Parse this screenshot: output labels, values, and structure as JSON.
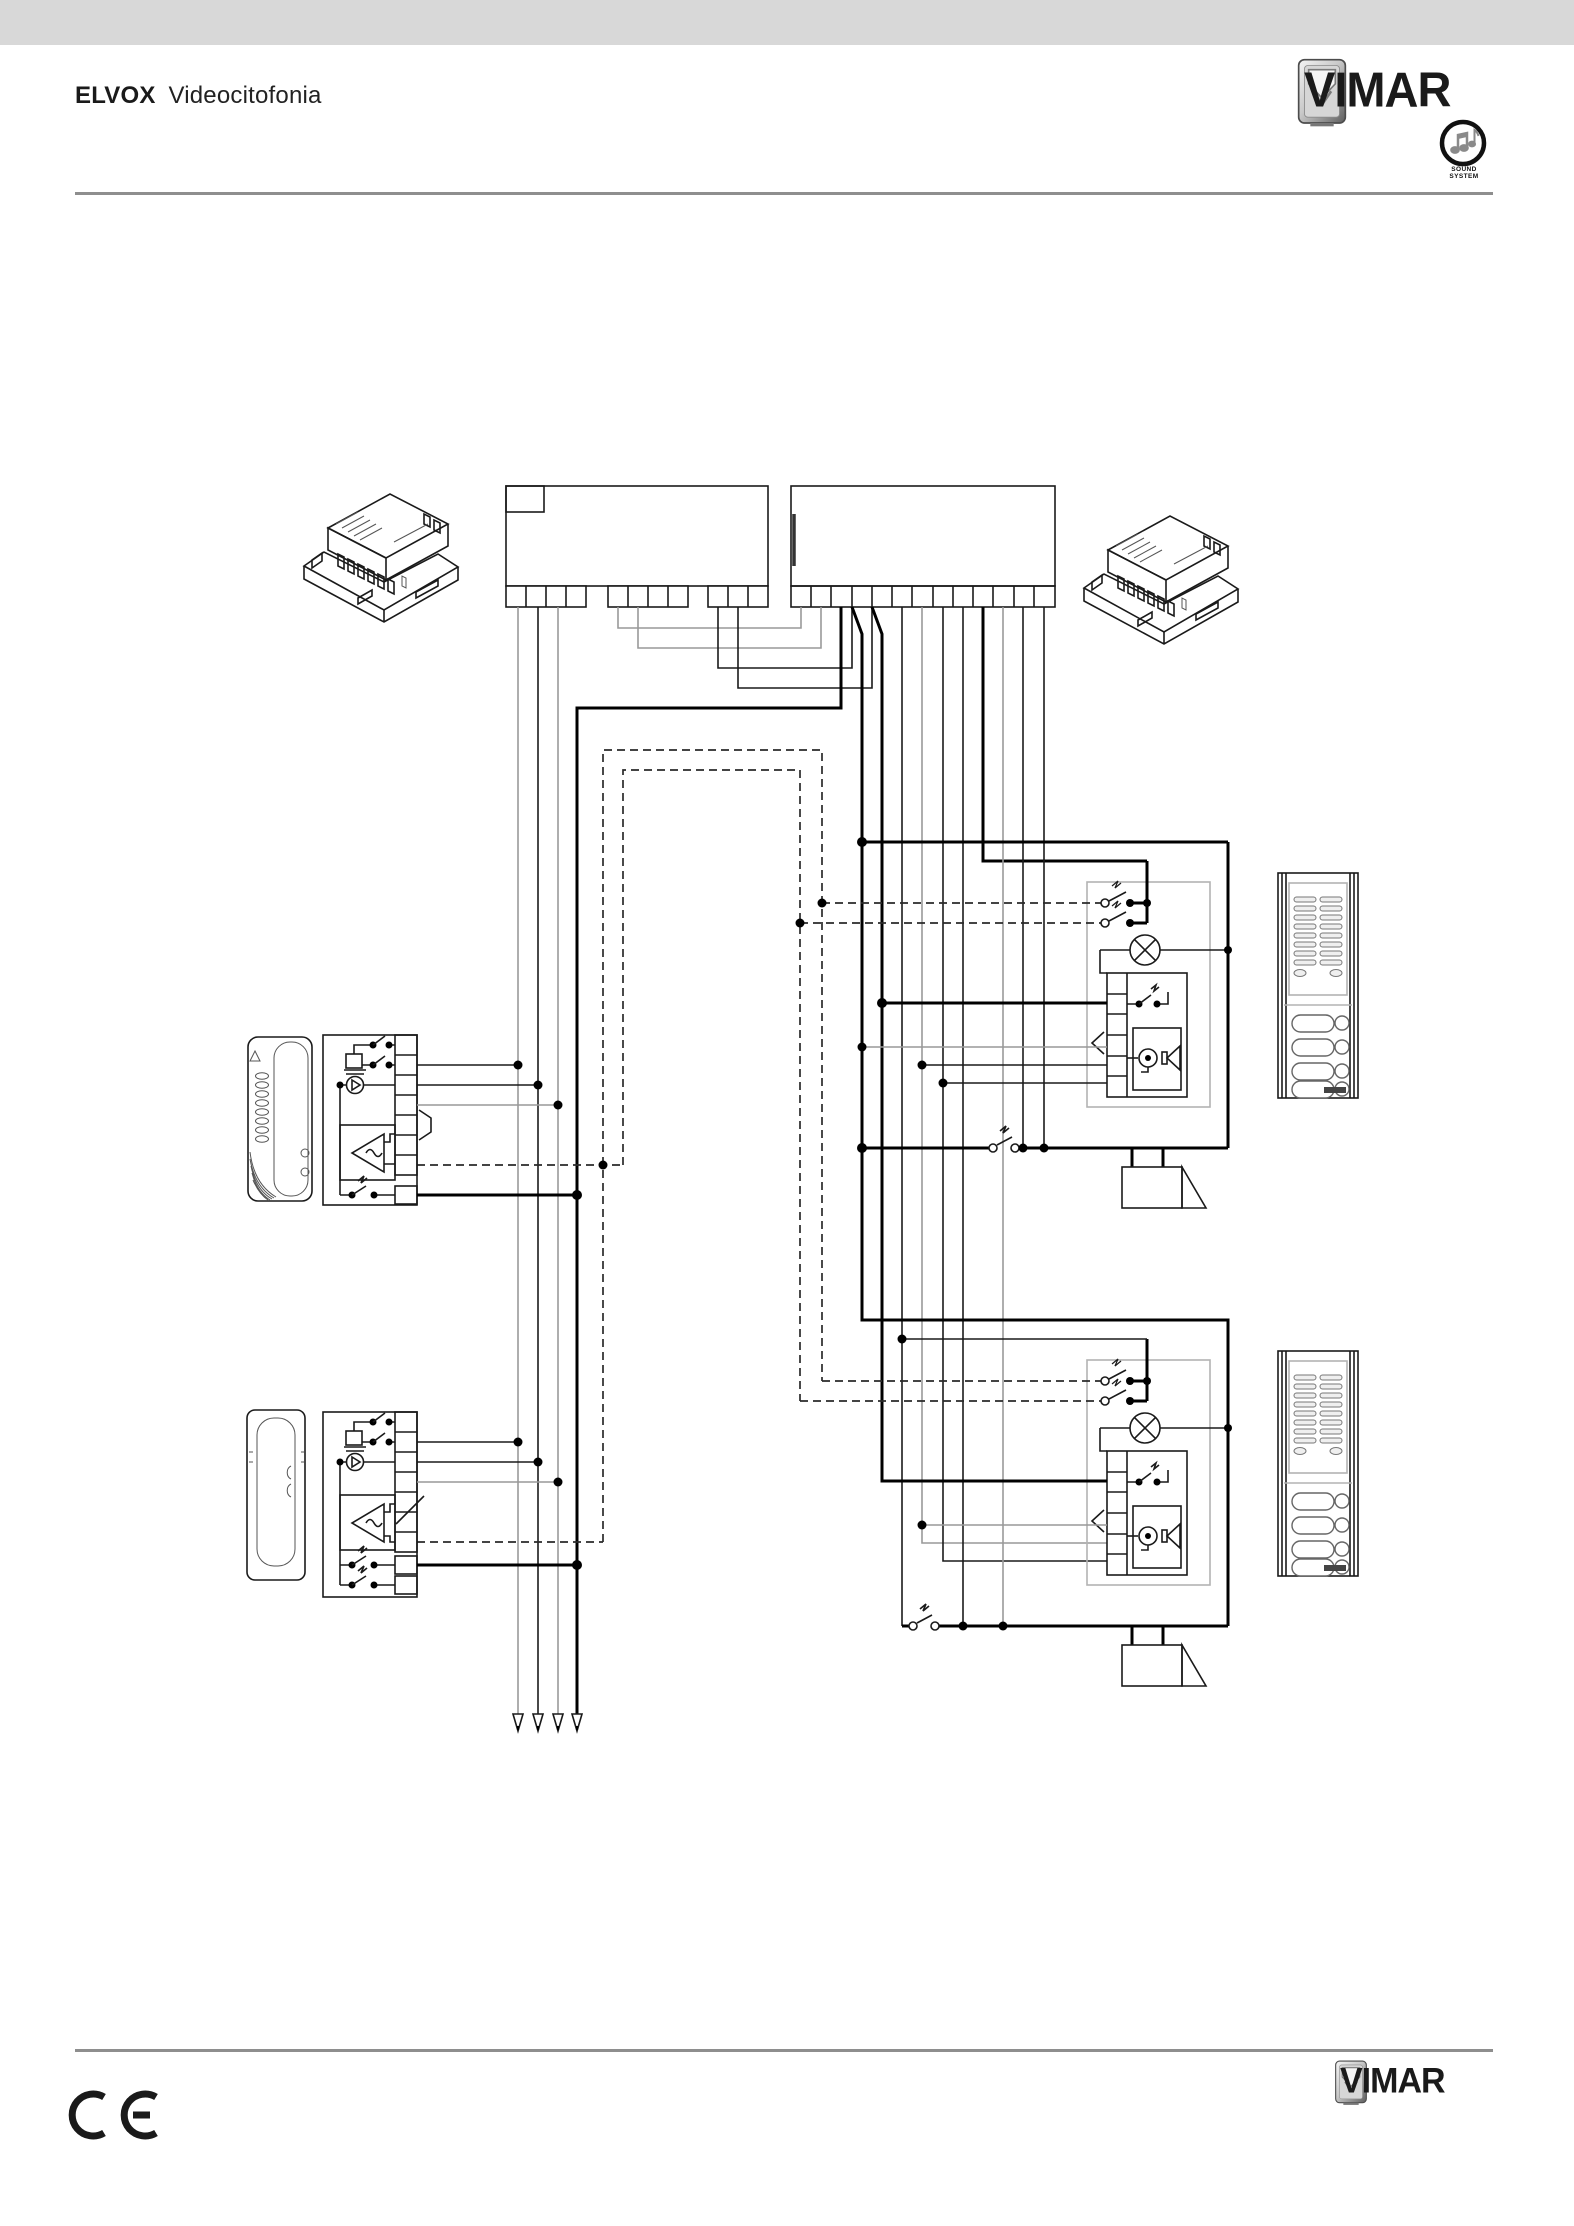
{
  "page": {
    "background": "#ffffff",
    "topbar_color": "#d8d8d8",
    "rule_color": "#8e8e8e"
  },
  "header": {
    "brand": "ELVOX",
    "product": "Videocitofonia",
    "logo_text": "VIMAR",
    "sound_system_label": "SOUND SYSTEM"
  },
  "footer": {
    "ce_mark": "CE",
    "logo_text": "VIMAR"
  },
  "diagram": {
    "type": "wiring-schematic",
    "description": "Audio door-entry system wiring diagram",
    "power_supply_modules": 2,
    "terminal_units": 2,
    "indoor_interphones": 2,
    "outdoor_entrance_panels": 2,
    "entrance_panel_call_buttons": 4,
    "electric_door_locks": 2,
    "riser_continuation_arrows": 4,
    "wire_colors": {
      "primary": "#1a1a1a",
      "secondary": "#999999",
      "thick_bus": "#000000"
    },
    "icons": [
      "din-power-supply-icon",
      "terminal-block-icon",
      "buzzer-icon",
      "receiver-icon",
      "amplifier-icon",
      "switch-icon",
      "lamp-icon",
      "microphone-icon",
      "speaker-icon",
      "door-lock-icon",
      "handset-icon",
      "entrance-panel-icon",
      "arrow-down-icon"
    ]
  }
}
